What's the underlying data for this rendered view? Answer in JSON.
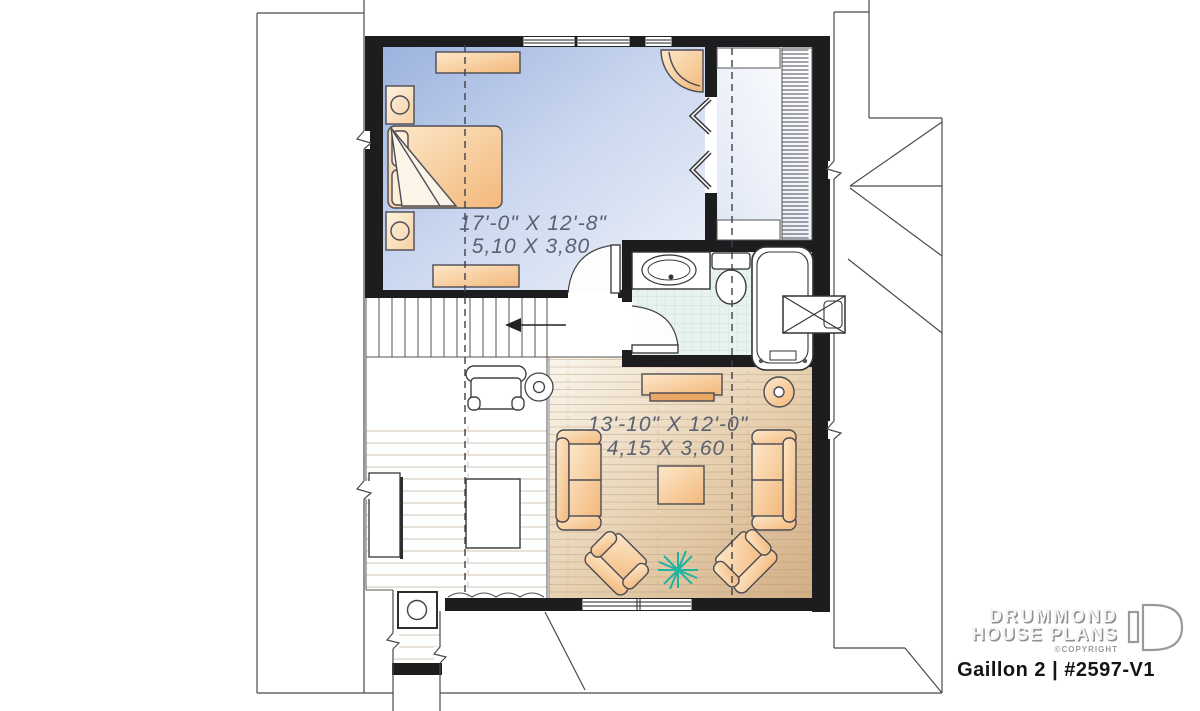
{
  "plan": {
    "rooms": [
      {
        "id": "bedroom",
        "dim_imperial": "17'-0\" X 12'-8\"",
        "dim_metric": "5,10 X 3,80"
      },
      {
        "id": "living-room",
        "dim_imperial": "13'-10\" X 12'-0\"",
        "dim_metric": "4,15 X 3,60"
      }
    ]
  },
  "branding": {
    "logo_line1": "DRUMMOND",
    "logo_line2": "HOUSE PLANS",
    "copyright": "©COPYRIGHT",
    "plan_title": "Gaillon 2 | #2597-V1"
  },
  "icons": {
    "stair_direction_arrow": "left-arrow",
    "plant": "starburst"
  },
  "colors": {
    "wall": "#1d1d1f",
    "furniture_fill": "#f5bf85",
    "furniture_outline": "#4b4b54",
    "bedroom_floor": "#a3b9e1",
    "closet_floor": "#dfe6f4",
    "tile_floor": "#e8f3ee",
    "wood_floor": "#d6b791",
    "plant": "#1fb3a0",
    "dim_text": "#5a6170",
    "logo_gray": "#9a9a9a"
  }
}
